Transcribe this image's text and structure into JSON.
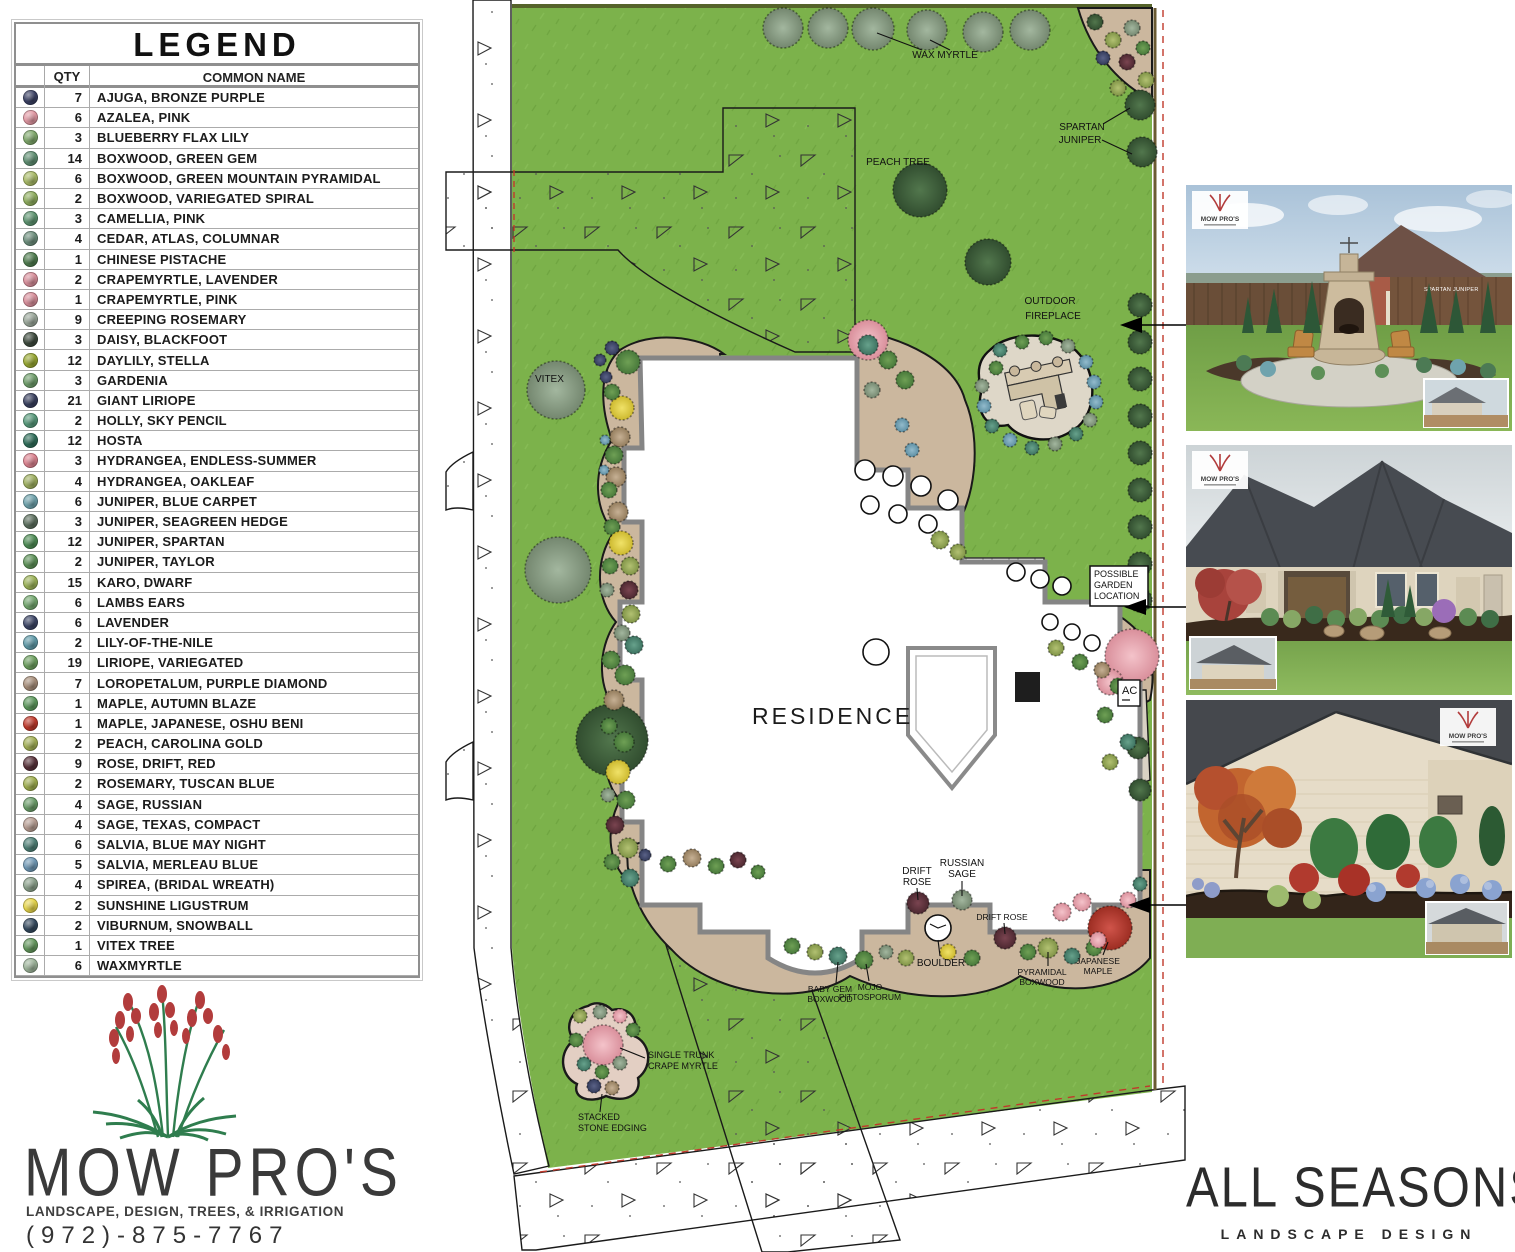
{
  "legend": {
    "title": "LEGEND",
    "col_qty": "QTY",
    "col_name": "COMMON NAME",
    "rows": [
      {
        "qty": "7",
        "name": "AJUGA, BRONZE PURPLE",
        "color": "#3a4063"
      },
      {
        "qty": "6",
        "name": "AZALEA, PINK",
        "color": "#e298a3"
      },
      {
        "qty": "3",
        "name": "BLUEBERRY FLAX LILY",
        "color": "#7fa86b"
      },
      {
        "qty": "14",
        "name": "BOXWOOD, GREEN GEM",
        "color": "#5f8f72"
      },
      {
        "qty": "6",
        "name": "BOXWOOD, GREEN MOUNTAIN PYRAMIDAL",
        "color": "#a9bb67"
      },
      {
        "qty": "2",
        "name": "BOXWOOD, VARIEGATED SPIRAL",
        "color": "#8fae5e"
      },
      {
        "qty": "3",
        "name": "CAMELLIA, PINK",
        "color": "#5d9470"
      },
      {
        "qty": "4",
        "name": "CEDAR, ATLAS, COLUMNAR",
        "color": "#6d8f7d"
      },
      {
        "qty": "1",
        "name": "CHINESE PISTACHE",
        "color": "#4f7d4f"
      },
      {
        "qty": "2",
        "name": "CRAPEMYRTLE, LAVENDER",
        "color": "#d98f9b"
      },
      {
        "qty": "1",
        "name": "CRAPEMYRTLE, PINK",
        "color": "#d98f9b"
      },
      {
        "qty": "9",
        "name": "CREEPING ROSEMARY",
        "color": "#9aa79a"
      },
      {
        "qty": "3",
        "name": "DAISY, BLACKFOOT",
        "color": "#3d4a3d"
      },
      {
        "qty": "12",
        "name": "DAYLILY, STELLA",
        "color": "#98a832"
      },
      {
        "qty": "3",
        "name": "GARDENIA",
        "color": "#6f9e6b"
      },
      {
        "qty": "21",
        "name": "GIANT LIRIOPE",
        "color": "#39405f"
      },
      {
        "qty": "2",
        "name": "HOLLY, SKY PENCIL",
        "color": "#579a7b"
      },
      {
        "qty": "12",
        "name": "HOSTA",
        "color": "#2f6e5a"
      },
      {
        "qty": "3",
        "name": "HYDRANGEA, ENDLESS-SUMMER",
        "color": "#dd8390"
      },
      {
        "qty": "4",
        "name": "HYDRANGEA, OAKLEAF",
        "color": "#9fb060"
      },
      {
        "qty": "6",
        "name": "JUNIPER, BLUE CARPET",
        "color": "#6fa3ad"
      },
      {
        "qty": "3",
        "name": "JUNIPER, SEAGREEN HEDGE",
        "color": "#5c6f5e"
      },
      {
        "qty": "12",
        "name": "JUNIPER, SPARTAN",
        "color": "#4e8d55"
      },
      {
        "qty": "2",
        "name": "JUNIPER, TAYLOR",
        "color": "#5d9258"
      },
      {
        "qty": "15",
        "name": "KARO, DWARF",
        "color": "#9cb358"
      },
      {
        "qty": "6",
        "name": "LAMBS EARS",
        "color": "#74a86f"
      },
      {
        "qty": "6",
        "name": "LAVENDER",
        "color": "#3c4566"
      },
      {
        "qty": "2",
        "name": "LILY-OF-THE-NILE",
        "color": "#5f9aa8"
      },
      {
        "qty": "19",
        "name": "LIRIOPE, VARIEGATED",
        "color": "#6da05f"
      },
      {
        "qty": "7",
        "name": "LOROPETALUM, PURPLE DIAMOND",
        "color": "#a78e7a"
      },
      {
        "qty": "1",
        "name": "MAPLE, AUTUMN BLAZE",
        "color": "#5d995d"
      },
      {
        "qty": "1",
        "name": "MAPLE, JAPANESE, OSHU BENI",
        "color": "#c0392b"
      },
      {
        "qty": "2",
        "name": "PEACH, CAROLINA GOLD",
        "color": "#a3b055"
      },
      {
        "qty": "9",
        "name": "ROSE, DRIFT, RED",
        "color": "#58313a"
      },
      {
        "qty": "2",
        "name": "ROSEMARY, TUSCAN BLUE",
        "color": "#9fae4e"
      },
      {
        "qty": "4",
        "name": "SAGE, RUSSIAN",
        "color": "#6a9d68"
      },
      {
        "qty": "4",
        "name": "SAGE, TEXAS, COMPACT",
        "color": "#b79d92"
      },
      {
        "qty": "6",
        "name": "SALVIA, BLUE MAY NIGHT",
        "color": "#4e8076"
      },
      {
        "qty": "5",
        "name": "SALVIA, MERLEAU BLUE",
        "color": "#6f98b5"
      },
      {
        "qty": "4",
        "name": "SPIREA, (BRIDAL WREATH)",
        "color": "#8aa08a"
      },
      {
        "qty": "2",
        "name": "SUNSHINE LIGUSTRUM",
        "color": "#e5d44a"
      },
      {
        "qty": "2",
        "name": "VIBURNUM, SNOWBALL",
        "color": "#34495e"
      },
      {
        "qty": "1",
        "name": "VITEX TREE",
        "color": "#63975c"
      },
      {
        "qty": "6",
        "name": "WAXMYRTLE",
        "color": "#9db49a"
      }
    ]
  },
  "logo": {
    "name": "MOW PRO'S",
    "tagline": "LANDSCAPE, DESIGN, TREES, & IRRIGATION",
    "phone": "(972)-875-7767"
  },
  "brand": {
    "name": "ALL SEASONS",
    "subtitle": "LANDSCAPE DESIGN"
  },
  "plan": {
    "labels": {
      "residence": "RESIDENCE",
      "wax_myrtle": "WAX MYRTLE",
      "spartan_1": "SPARTAN",
      "spartan_2": "JUNIPER",
      "peach_tree": "PEACH TREE",
      "outdoor_1": "OUTDOOR",
      "outdoor_2": "FIREPLACE",
      "vitex": "VITEX",
      "possible_1": "POSSIBLE",
      "possible_2": "GARDEN",
      "possible_3": "LOCATION",
      "ac": "AC",
      "drift_1": "DRIFT",
      "drift_2": "ROSE",
      "russian_1": "RUSSIAN",
      "russian_2": "SAGE",
      "drift_rose_small": "DRIFT ROSE",
      "boulder": "BOULDER",
      "pyramidal_1": "PYRAMIDAL",
      "pyramidal_2": "BOXWOOD",
      "jmaple_1": "JAPANESE",
      "jmaple_2": "MAPLE",
      "babygem_1": "BABY GEM",
      "babygem_2": "BOXWOOD",
      "mojo_1": "MOJO",
      "mojo_2": "PITTOSPORUM",
      "single_1": "SINGLE TRUNK",
      "single_2": "CRAPE MYRTLE",
      "stacked_1": "STACKED",
      "stacked_2": "STONE EDGING"
    }
  },
  "photos": [
    {
      "label": "SPARTAN JUNIPER"
    }
  ]
}
